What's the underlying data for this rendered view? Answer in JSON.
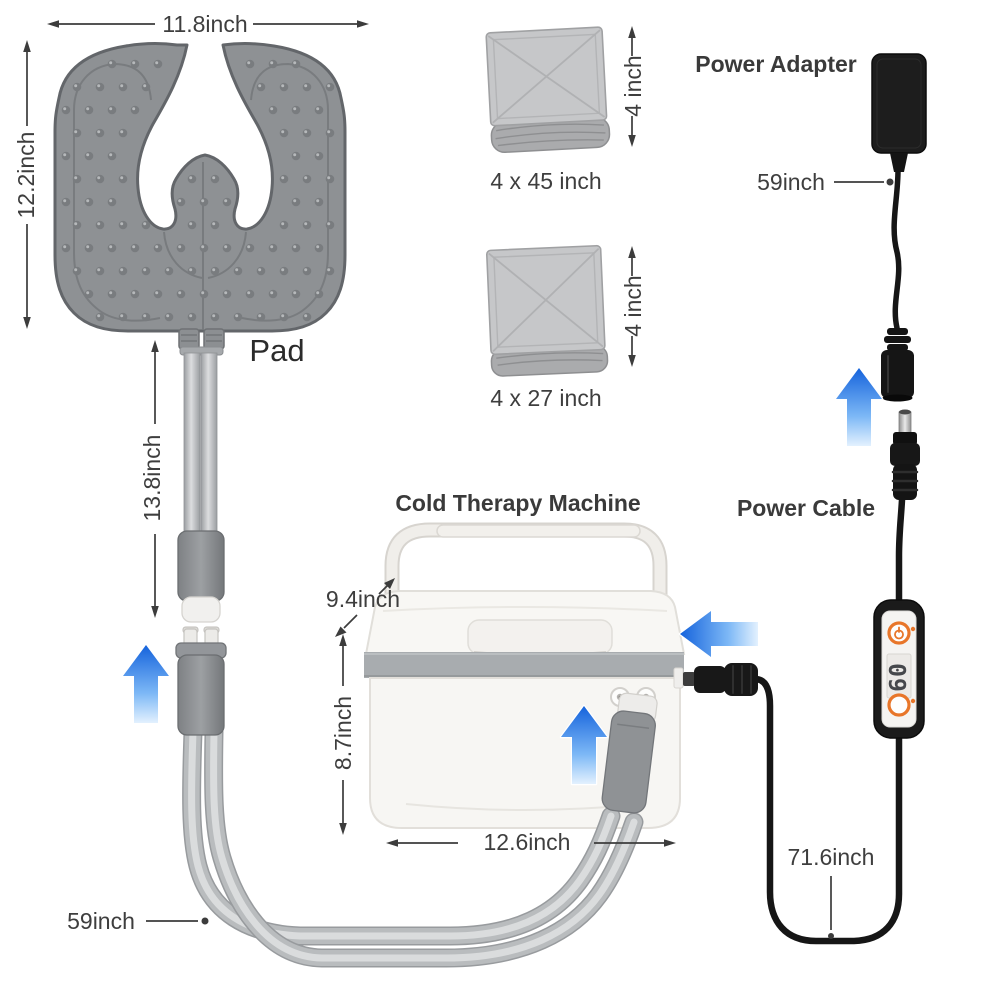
{
  "pad": {
    "label": "Pad",
    "width_dim": "11.8inch",
    "height_dim": "12.2inch",
    "tube_length_dim": "13.8inch",
    "hose_length_dim": "59inch"
  },
  "straps": [
    {
      "size_label": "4 x 45 inch",
      "width_dim": "4 inch"
    },
    {
      "size_label": "4 x 27 inch",
      "width_dim": "4 inch"
    }
  ],
  "power_adapter": {
    "title": "Power Adapter",
    "cable_length_dim": "59inch"
  },
  "power_cable": {
    "title": "Power Cable",
    "length_dim": "71.6inch",
    "controller_display_value": "60"
  },
  "machine": {
    "title": "Cold Therapy Machine",
    "depth_dim": "9.4inch",
    "height_dim": "8.7inch",
    "width_dim": "12.6inch"
  },
  "colors": {
    "arrow_blue": "#1563dc",
    "button_orange": "#e8762a",
    "pad_gray": "#8e9194",
    "cable_black": "#161616",
    "text_gray": "#3e3e3e"
  }
}
